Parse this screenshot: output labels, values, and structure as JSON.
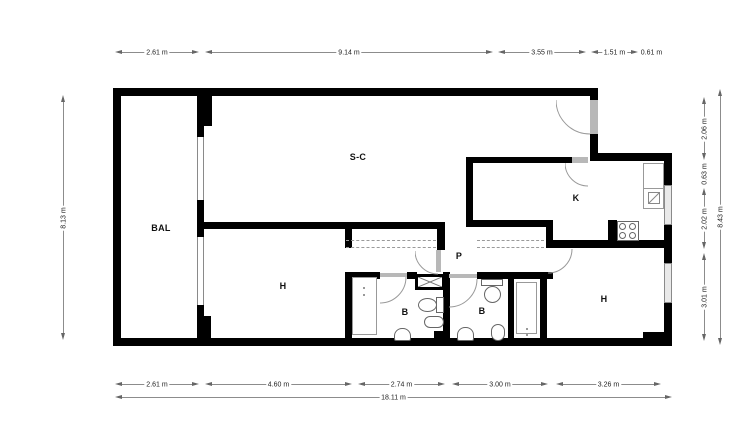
{
  "plan": {
    "rooms": {
      "balcony": "BAL",
      "living": "S-C",
      "kitchen": "K",
      "bedroom_left": "H",
      "passage": "P",
      "bath_left": "B",
      "bath_right": "B",
      "bedroom_right": "H"
    },
    "dims": {
      "top": [
        "2.61 m",
        "9.14 m",
        "3.55 m",
        "1.51 m",
        "0.61 m"
      ],
      "bottom": [
        "2.61 m",
        "4.60 m",
        "2.74 m",
        "3.00 m",
        "3.26 m"
      ],
      "bottom_total": "18.11 m",
      "left": "8.13 m",
      "right": [
        "2.06 m",
        "0.63 m",
        "2.02 m",
        "3.01 m"
      ],
      "right_total": "8.43 m"
    },
    "colors": {
      "wall": "#000000",
      "window": "#9a9a9a",
      "dimension": "#666666"
    }
  }
}
